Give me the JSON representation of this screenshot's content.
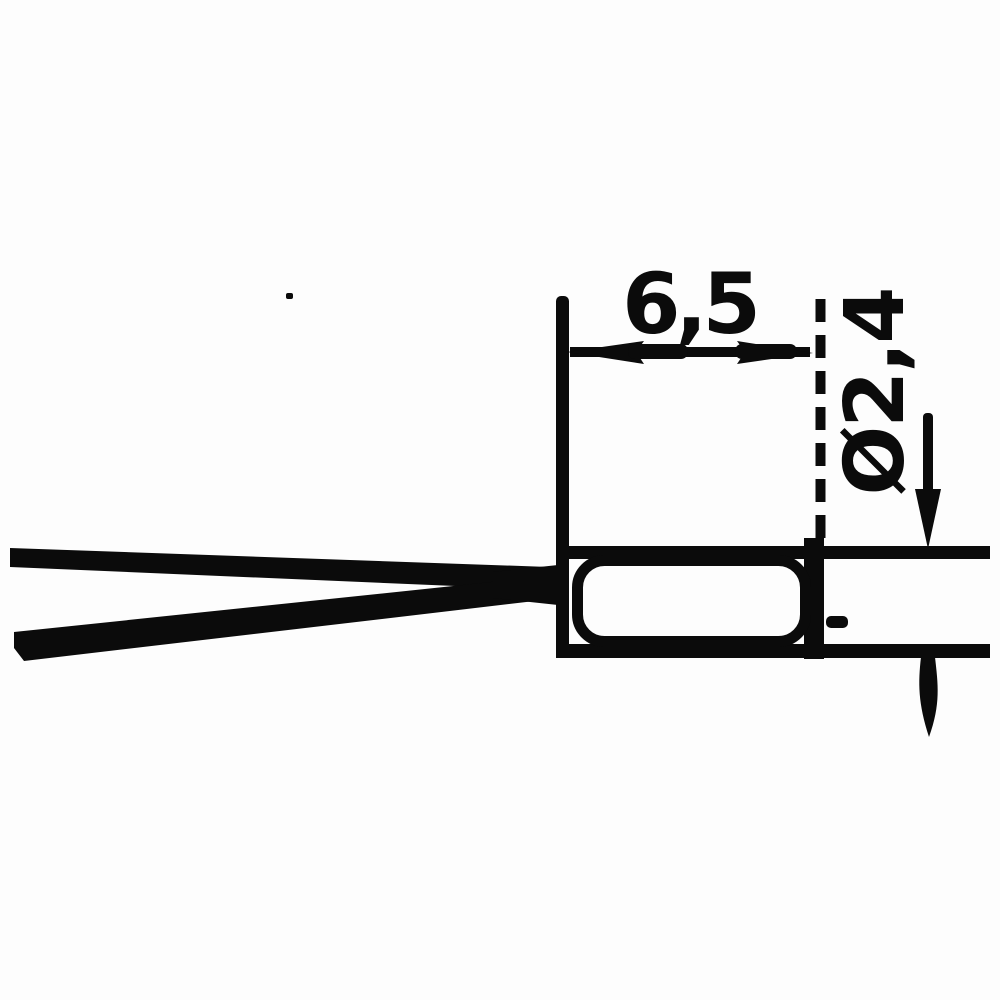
{
  "drawing": {
    "length_label": "6,5",
    "diameter_label": "Ø2,4",
    "ink_color": "#0b0b0b",
    "background_color": "#fdfdfd"
  }
}
